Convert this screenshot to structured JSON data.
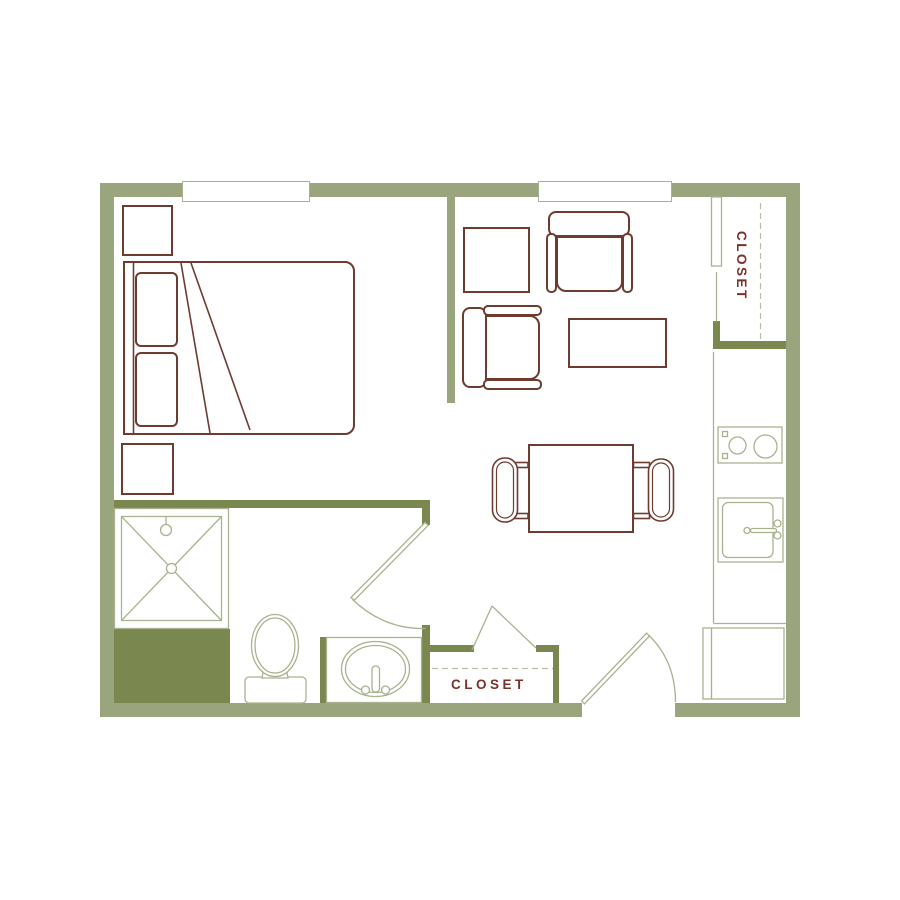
{
  "image_type": "studio-apartment-floor-plan",
  "labels": {
    "closet_upper_right": "CLOSET",
    "closet_lower": "CLOSET"
  },
  "colors": {
    "background": "#FFFFFF",
    "exterior_wall": "#9BA57D",
    "interior_wall": "#7A8850",
    "fixture_line": "#A9B28F",
    "dashed_line": "#B8C0A3",
    "furniture_line": "#6E3B31",
    "label_text": "#7B312A"
  }
}
